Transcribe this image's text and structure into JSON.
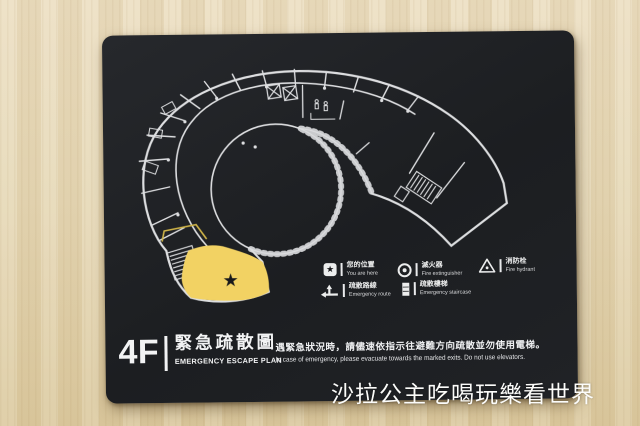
{
  "sign": {
    "floor_label": "4F",
    "title_zh": "緊急疏散圖",
    "title_en": "EMERGENCY ESCAPE PLAN",
    "notice_zh": "遇緊急狀況時，請儘速依指示往避難方向疏散並勿使用電梯。",
    "notice_en": "In case of emergency, please evacuate towards the marked exits. Do not use elevators.",
    "legend": {
      "you_are_here": {
        "zh": "您的位置",
        "en": "You are here"
      },
      "fire_extinguisher": {
        "zh": "滅火器",
        "en": "Fire extinguisher"
      },
      "fire_hydrant": {
        "zh": "消防栓",
        "en": "Fire hydrant"
      },
      "emergency_route": {
        "zh": "疏散路線",
        "en": "Emergency route"
      },
      "emergency_staircase": {
        "zh": "疏散樓梯",
        "en": "Emergency staircase"
      }
    },
    "map": {
      "marker_glyph": "★"
    },
    "colors": {
      "sign_background": "#1e2023",
      "plan_line": "#e8e9eb",
      "you_are_here_fill": "#f2d263",
      "route_highlight": "#d9bc4a",
      "wood": "#e6d8b6"
    }
  },
  "watermark": {
    "text": "沙拉公主吃喝玩樂看世界"
  }
}
